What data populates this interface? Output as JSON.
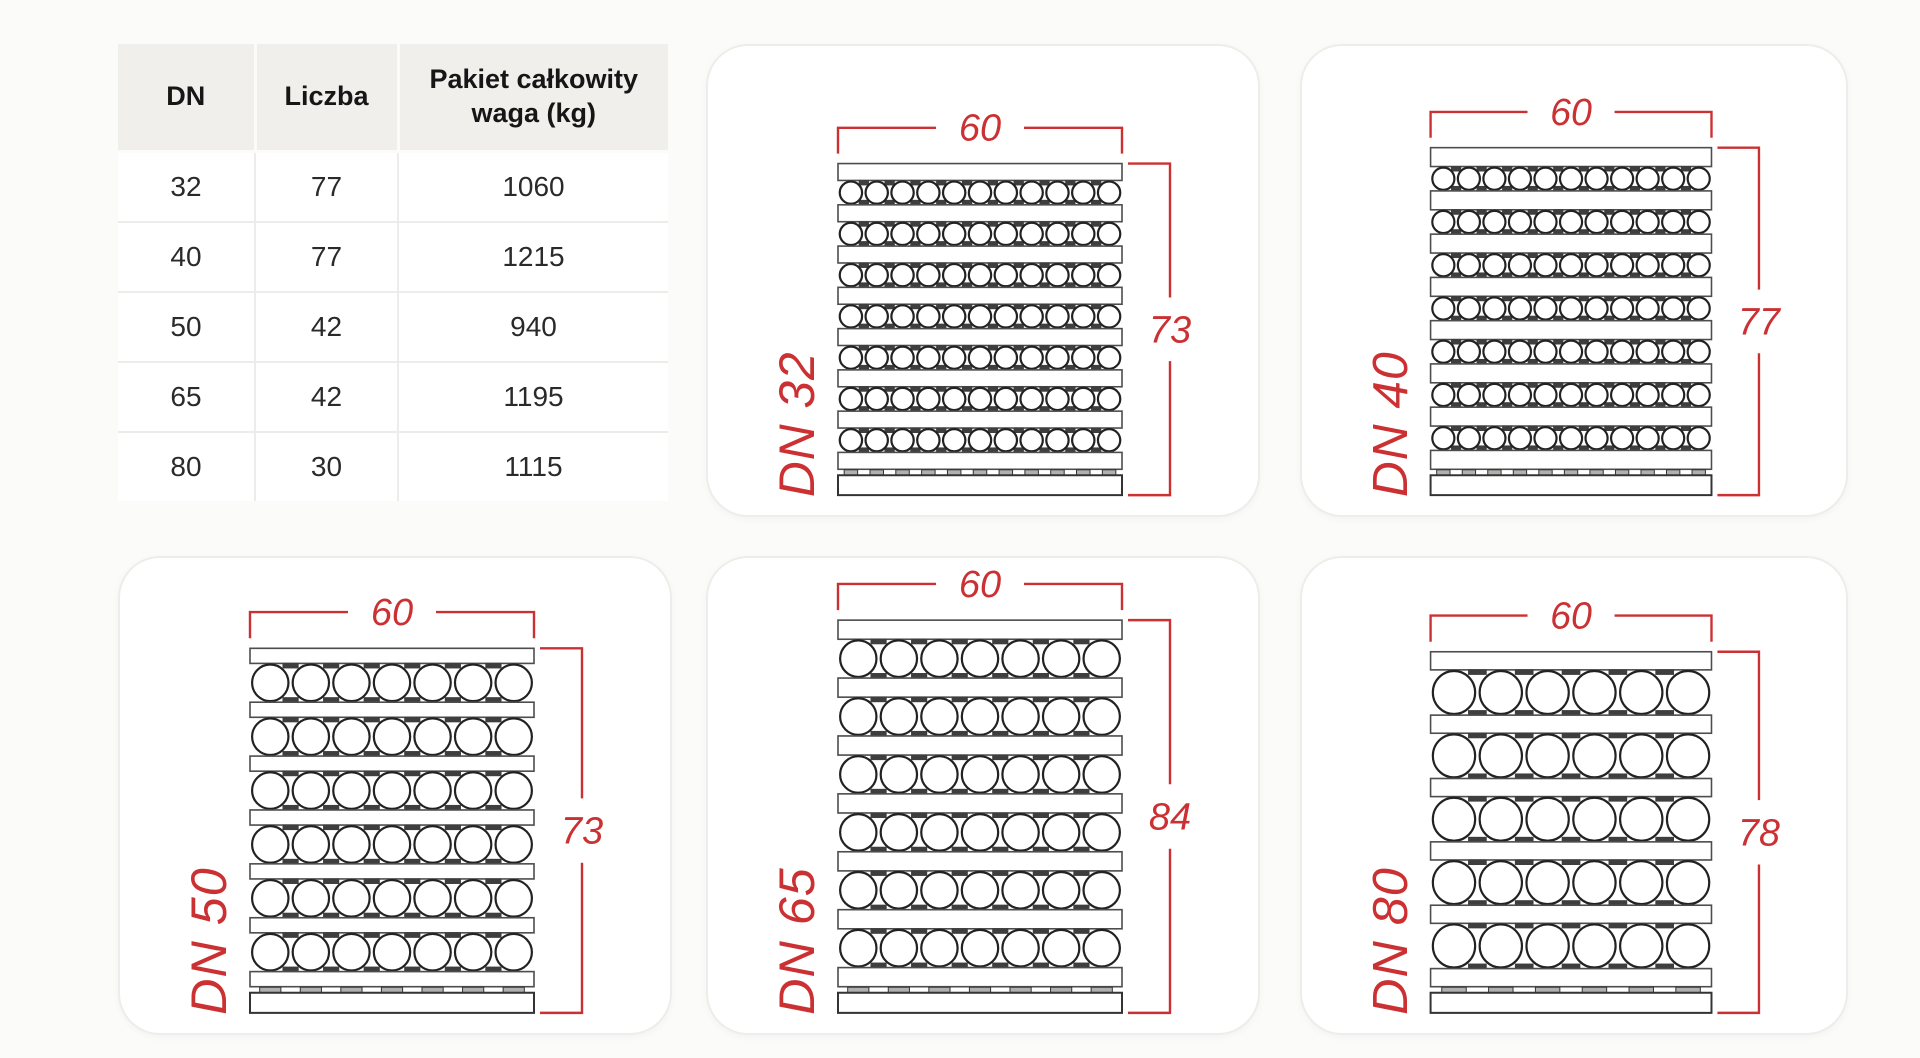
{
  "table": {
    "headers": [
      "DN",
      "Liczba",
      "Pakiet całkowity waga (kg)"
    ],
    "rows": [
      {
        "dn": "32",
        "liczba": "77",
        "waga": "1060"
      },
      {
        "dn": "40",
        "liczba": "77",
        "waga": "1215"
      },
      {
        "dn": "50",
        "liczba": "42",
        "waga": "940"
      },
      {
        "dn": "65",
        "liczba": "42",
        "waga": "1195"
      },
      {
        "dn": "80",
        "liczba": "30",
        "waga": "1115"
      }
    ]
  },
  "cards": [
    {
      "id": "dn32",
      "label": "DN 32",
      "width_label": "60",
      "height_label": "73",
      "rows": 7,
      "pipes_per_row": 11,
      "total_pipes": 77
    },
    {
      "id": "dn40",
      "label": "DN 40",
      "width_label": "60",
      "height_label": "77",
      "rows": 7,
      "pipes_per_row": 11,
      "total_pipes": 77
    },
    {
      "id": "dn50",
      "label": "DN 50",
      "width_label": "60",
      "height_label": "73",
      "rows": 6,
      "pipes_per_row": 7,
      "total_pipes": 42
    },
    {
      "id": "dn65",
      "label": "DN 65",
      "width_label": "60",
      "height_label": "84",
      "rows": 6,
      "pipes_per_row": 7,
      "total_pipes": 42
    },
    {
      "id": "dn80",
      "label": "DN 80",
      "width_label": "60",
      "height_label": "78",
      "rows": 5,
      "pipes_per_row": 6,
      "total_pipes": 30
    }
  ],
  "colors": {
    "accent_red": "#cb3133",
    "circle_stroke": "#222222",
    "plank_stroke": "#4d4d4d",
    "base_stroke": "#333333",
    "tab_fill": "#3e3e3e",
    "pallet_tab_fill": "#b2b0ae",
    "header_bg": "#f0efec",
    "cell_border": "#edecea",
    "card_border": "#ededea",
    "page_bg": "#fbfbfa"
  }
}
